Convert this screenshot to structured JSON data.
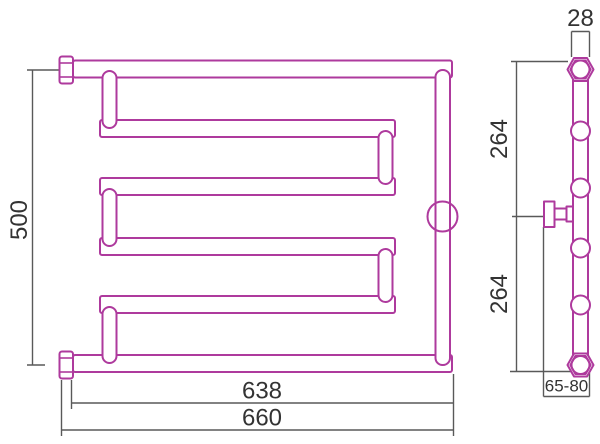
{
  "colors": {
    "outline": "#ae3a9d",
    "dimension_line": "#595959",
    "dimension_text": "#333333",
    "background": "#ffffff"
  },
  "front_view": {
    "dim_height": "500",
    "dim_width_pipe": "638",
    "dim_width_overall": "660"
  },
  "side_view": {
    "dim_diameter": "28",
    "dim_span_upper": "264",
    "dim_span_lower": "264",
    "dim_wall_offset": "65-80"
  }
}
